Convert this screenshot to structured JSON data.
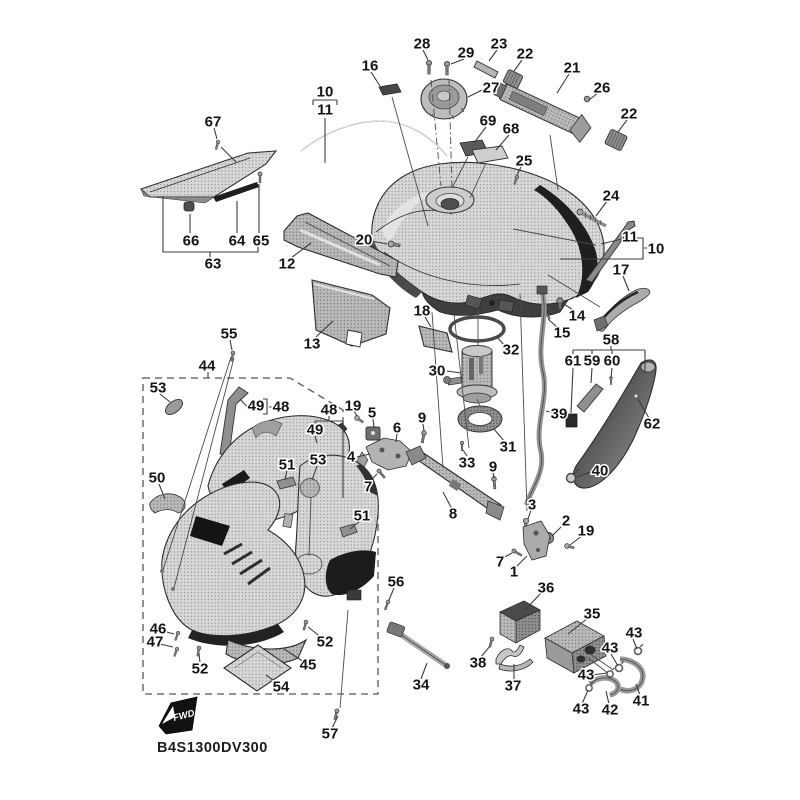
{
  "diagram": {
    "part_code": "B4S1300DV300",
    "fwd_label": "FWD",
    "colors": {
      "background": "#ffffff",
      "line": "#3c3c3c",
      "part_dark": "#1f1f1f"
    },
    "callouts": [
      {
        "label": "28",
        "x": 422,
        "y": 44
      },
      {
        "label": "23",
        "x": 499,
        "y": 44
      },
      {
        "label": "29",
        "x": 466,
        "y": 53
      },
      {
        "label": "22",
        "x": 525,
        "y": 54
      },
      {
        "label": "16",
        "x": 370,
        "y": 66
      },
      {
        "label": "21",
        "x": 572,
        "y": 68
      },
      {
        "label": "27",
        "x": 491,
        "y": 88
      },
      {
        "label": "26",
        "x": 602,
        "y": 88
      },
      {
        "label": "10",
        "x": 325,
        "y": 92
      },
      {
        "label": "11",
        "x": 325,
        "y": 110
      },
      {
        "label": "22",
        "x": 629,
        "y": 114
      },
      {
        "label": "69",
        "x": 488,
        "y": 121
      },
      {
        "label": "67",
        "x": 213,
        "y": 122
      },
      {
        "label": "68",
        "x": 511,
        "y": 129
      },
      {
        "label": "25",
        "x": 524,
        "y": 161
      },
      {
        "label": "24",
        "x": 611,
        "y": 196
      },
      {
        "label": "11",
        "x": 630,
        "y": 237
      },
      {
        "label": "20",
        "x": 364,
        "y": 240
      },
      {
        "label": "66",
        "x": 191,
        "y": 241
      },
      {
        "label": "64",
        "x": 237,
        "y": 241
      },
      {
        "label": "65",
        "x": 261,
        "y": 241
      },
      {
        "label": "10",
        "x": 656,
        "y": 249
      },
      {
        "label": "63",
        "x": 213,
        "y": 264
      },
      {
        "label": "12",
        "x": 287,
        "y": 264
      },
      {
        "label": "17",
        "x": 621,
        "y": 270
      },
      {
        "label": "18",
        "x": 422,
        "y": 311
      },
      {
        "label": "14",
        "x": 577,
        "y": 316
      },
      {
        "label": "15",
        "x": 562,
        "y": 333
      },
      {
        "label": "55",
        "x": 229,
        "y": 334
      },
      {
        "label": "58",
        "x": 611,
        "y": 340
      },
      {
        "label": "13",
        "x": 312,
        "y": 344
      },
      {
        "label": "32",
        "x": 511,
        "y": 350
      },
      {
        "label": "61",
        "x": 573,
        "y": 361
      },
      {
        "label": "59",
        "x": 592,
        "y": 361
      },
      {
        "label": "60",
        "x": 612,
        "y": 361
      },
      {
        "label": "44",
        "x": 207,
        "y": 366
      },
      {
        "label": "30",
        "x": 437,
        "y": 371
      },
      {
        "label": "53",
        "x": 158,
        "y": 388
      },
      {
        "label": "19",
        "x": 353,
        "y": 406
      },
      {
        "label": "49",
        "x": 256,
        "y": 406
      },
      {
        "label": "48",
        "x": 281,
        "y": 407
      },
      {
        "label": "48",
        "x": 329,
        "y": 410
      },
      {
        "label": "5",
        "x": 372,
        "y": 413
      },
      {
        "label": "39",
        "x": 559,
        "y": 414
      },
      {
        "label": "9",
        "x": 422,
        "y": 418
      },
      {
        "label": "6",
        "x": 397,
        "y": 428
      },
      {
        "label": "49",
        "x": 315,
        "y": 430
      },
      {
        "label": "62",
        "x": 652,
        "y": 424
      },
      {
        "label": "31",
        "x": 508,
        "y": 447
      },
      {
        "label": "4",
        "x": 351,
        "y": 457
      },
      {
        "label": "53",
        "x": 318,
        "y": 460
      },
      {
        "label": "33",
        "x": 467,
        "y": 463
      },
      {
        "label": "51",
        "x": 287,
        "y": 465
      },
      {
        "label": "9",
        "x": 493,
        "y": 467
      },
      {
        "label": "40",
        "x": 600,
        "y": 471
      },
      {
        "label": "50",
        "x": 157,
        "y": 478
      },
      {
        "label": "7",
        "x": 368,
        "y": 487
      },
      {
        "label": "3",
        "x": 532,
        "y": 505
      },
      {
        "label": "8",
        "x": 453,
        "y": 514
      },
      {
        "label": "51",
        "x": 362,
        "y": 516
      },
      {
        "label": "2",
        "x": 566,
        "y": 521
      },
      {
        "label": "19",
        "x": 586,
        "y": 531
      },
      {
        "label": "7",
        "x": 500,
        "y": 562
      },
      {
        "label": "1",
        "x": 514,
        "y": 572
      },
      {
        "label": "56",
        "x": 396,
        "y": 582
      },
      {
        "label": "36",
        "x": 546,
        "y": 588
      },
      {
        "label": "35",
        "x": 592,
        "y": 614
      },
      {
        "label": "46",
        "x": 158,
        "y": 629
      },
      {
        "label": "43",
        "x": 634,
        "y": 633
      },
      {
        "label": "47",
        "x": 155,
        "y": 642
      },
      {
        "label": "52",
        "x": 325,
        "y": 642
      },
      {
        "label": "43",
        "x": 610,
        "y": 648
      },
      {
        "label": "38",
        "x": 478,
        "y": 663
      },
      {
        "label": "45",
        "x": 308,
        "y": 665
      },
      {
        "label": "52",
        "x": 200,
        "y": 669
      },
      {
        "label": "43",
        "x": 586,
        "y": 675
      },
      {
        "label": "34",
        "x": 421,
        "y": 685
      },
      {
        "label": "37",
        "x": 513,
        "y": 686
      },
      {
        "label": "54",
        "x": 281,
        "y": 687
      },
      {
        "label": "41",
        "x": 641,
        "y": 701
      },
      {
        "label": "43",
        "x": 581,
        "y": 709
      },
      {
        "label": "42",
        "x": 610,
        "y": 710
      },
      {
        "label": "57",
        "x": 330,
        "y": 734
      }
    ]
  }
}
